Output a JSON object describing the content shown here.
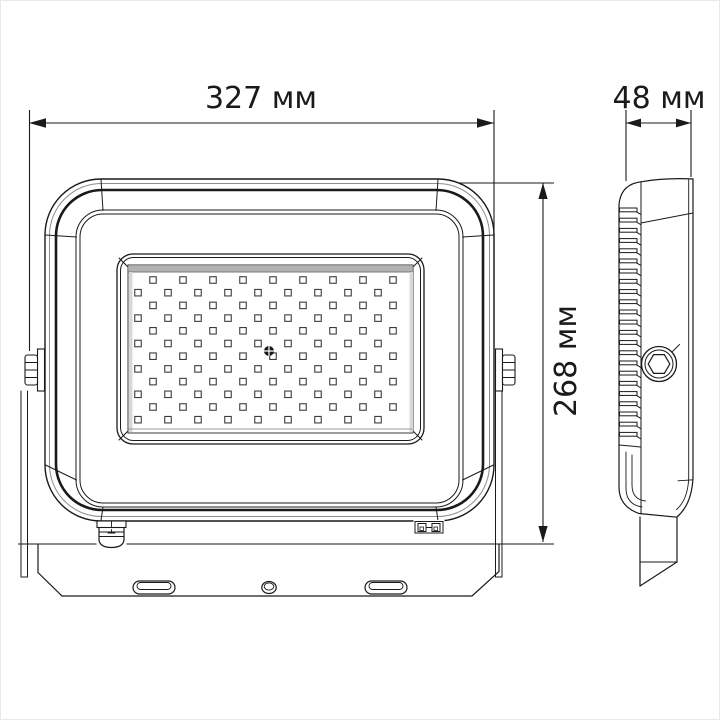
{
  "drawing": {
    "kind": "technical-dimension-drawing",
    "subject": "led-floodlight",
    "views": [
      "front",
      "side"
    ]
  },
  "dimensions": {
    "width": {
      "label": "327 мм",
      "value": 327,
      "unit": "мм"
    },
    "height": {
      "label": "268 мм",
      "value": 268,
      "unit": "мм"
    },
    "depth": {
      "label": "48 мм",
      "value": 48,
      "unit": "мм"
    }
  },
  "colors": {
    "line": "#1a1a1a",
    "line_soft": "#8d8d8d",
    "shade_top": "#b2b2b2",
    "shade_side": "#d8d8d8",
    "led_stroke": "#3c3c3c",
    "background": "#ffffff"
  },
  "led_grid": {
    "rows": 12,
    "cols": 9,
    "first_row_y": 280,
    "row_step": 12.7,
    "odd_row_x": 153,
    "even_row_x": 138,
    "col_step": 30,
    "size": 6.5
  },
  "fins": {
    "count": 23,
    "x": 619.5,
    "width": 17.5,
    "height": 3.8,
    "first_y": 208,
    "step": 10.2
  }
}
